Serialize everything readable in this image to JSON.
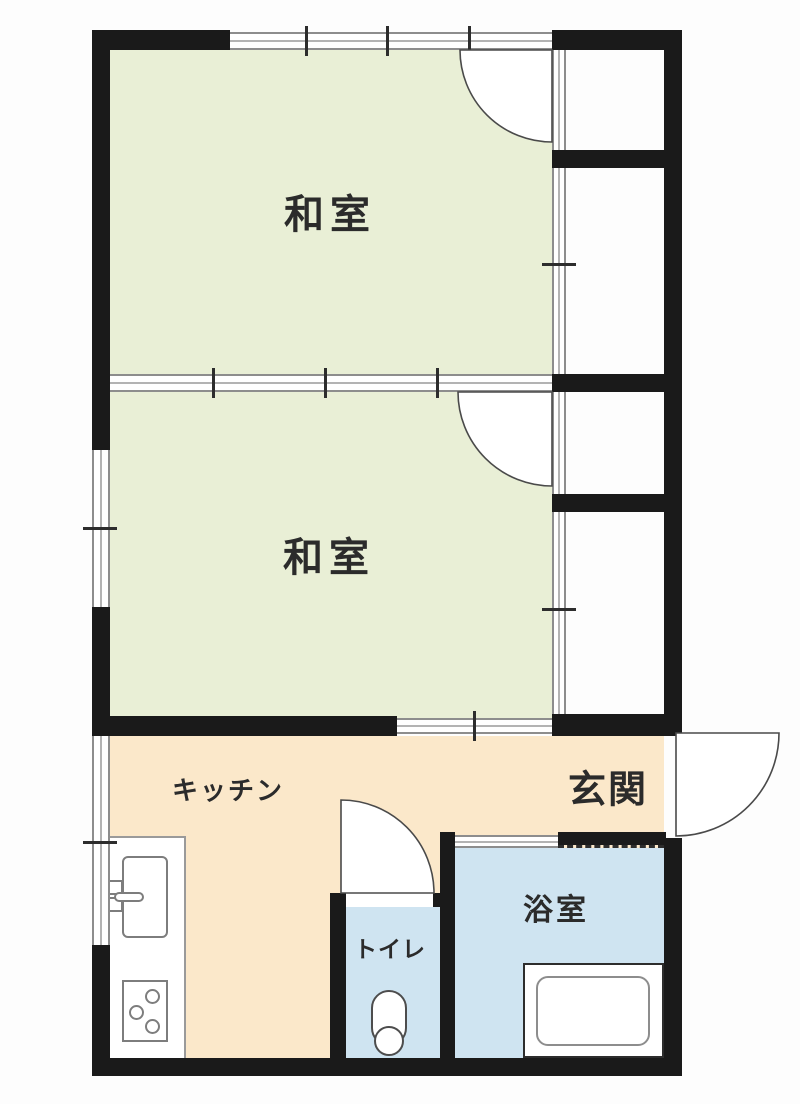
{
  "title": "1K/2K apartment floor plan",
  "rooms": [
    {
      "name": "washitsu-1",
      "label": "和室"
    },
    {
      "name": "washitsu-2",
      "label": "和室"
    },
    {
      "name": "kitchen",
      "label": "キッチン"
    },
    {
      "name": "genkan",
      "label": "玄関"
    },
    {
      "name": "toilet",
      "label": "トイレ"
    },
    {
      "name": "bathroom",
      "label": "浴室"
    }
  ],
  "colors": {
    "tatami_room": "#e9efd6",
    "kitchen_floor": "#fbe8ca",
    "wet_area": "#cfe4f1",
    "wall": "#1a1a1a"
  },
  "fixtures": [
    "kitchen-sink",
    "gas-stove",
    "toilet",
    "bathtub"
  ]
}
